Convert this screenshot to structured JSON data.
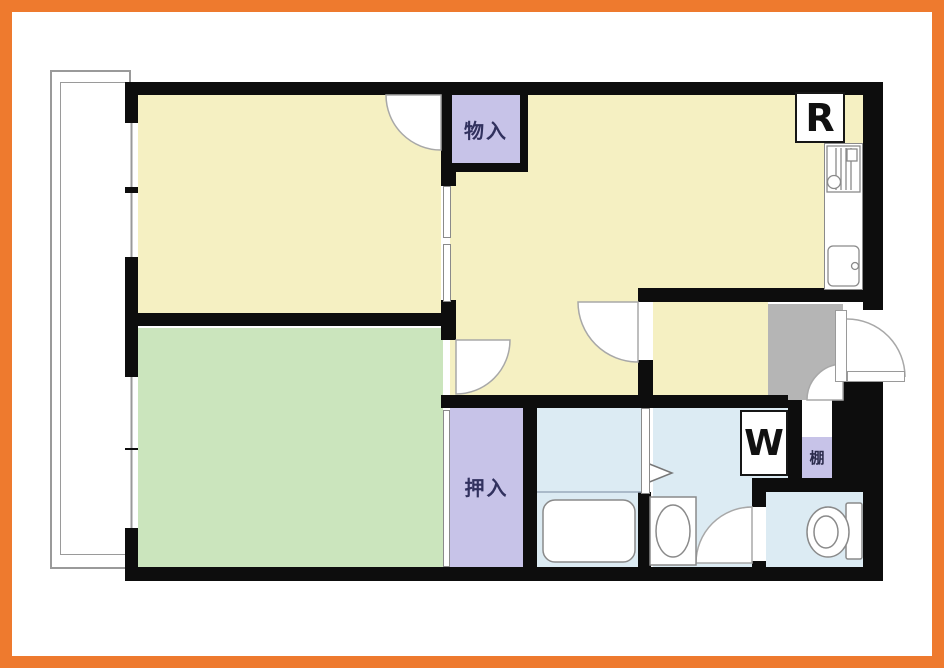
{
  "labels": {
    "storage_upper": "物入",
    "oshiire": "押入",
    "refrigerator": "R",
    "washer": "W",
    "shelf": "棚"
  },
  "colors": {
    "frame_orange": "#ee7a2e",
    "wall_black": "#0d0d0d",
    "room_yellow": "#f5f0c2",
    "room_green": "#cbe5bd",
    "closet_purple": "#c7c3e8",
    "water_blue": "#dcebf3",
    "genkan_gray": "#b5b5b5"
  },
  "icons": {
    "bathtub": "rounded-rectangle",
    "washbasin": "cabinet-with-oval-bowl",
    "toilet": "bowl-with-tank",
    "stove": "grill-bars-with-burner",
    "sink": "rounded-basin-with-faucet",
    "door": "quarter-circle-swing-arc",
    "refrigerator_box": "square-with-corner-ticks",
    "washer_box": "square-with-corner-ticks"
  }
}
